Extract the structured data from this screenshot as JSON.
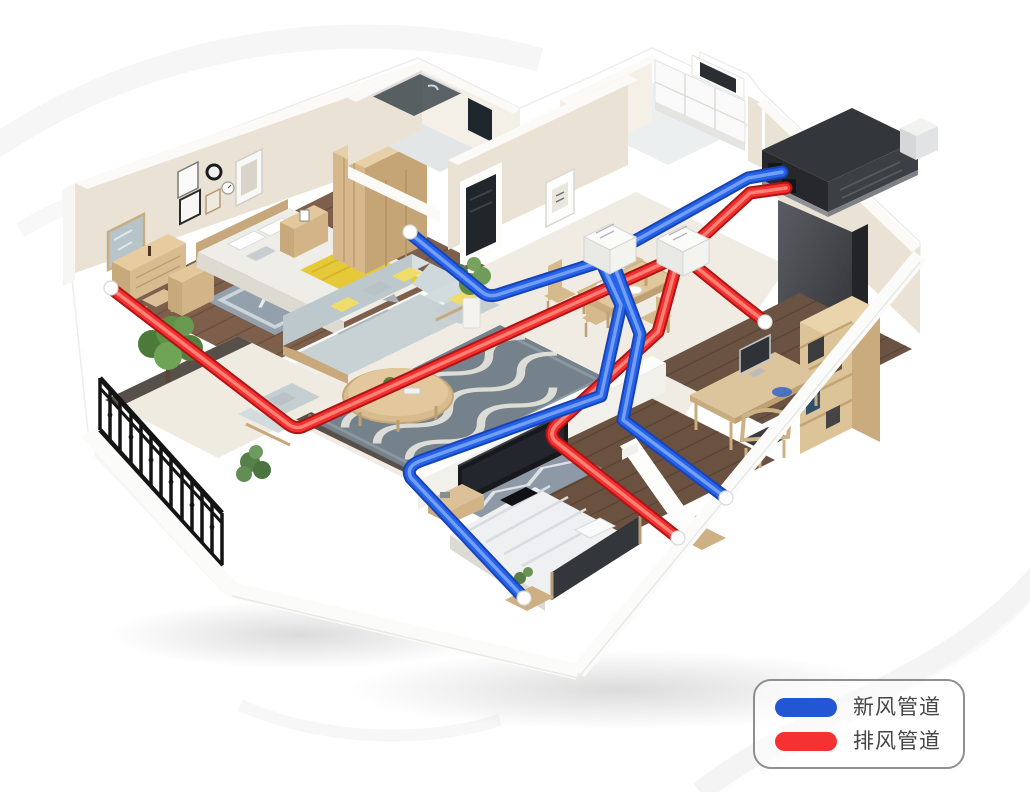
{
  "legend": {
    "items": [
      {
        "id": "fresh",
        "label": "新风管道"
      },
      {
        "id": "exhaust",
        "label": "排风管道"
      }
    ]
  },
  "colors": {
    "background": "#ffffff",
    "fresh_base": "#1843b8",
    "fresh_main": "#2563e8",
    "fresh_shine": "#82a9f8",
    "exhaust_base": "#b01414",
    "exhaust_main": "#f43030",
    "exhaust_shine": "#ff9182",
    "legend_fresh": "#2356d4",
    "legend_exhaust": "#f53131",
    "legend_border": "#8f8f8f",
    "legend_text": "#464646"
  }
}
